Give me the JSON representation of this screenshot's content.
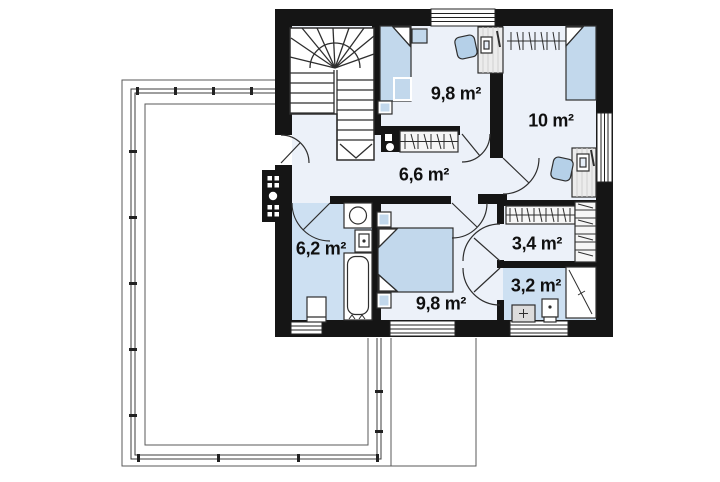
{
  "page": {
    "background_color": "#ffffff"
  },
  "floorplan": {
    "kind": "floor-plan-second-storey",
    "colors": {
      "wall": "#151515",
      "floor": "#ecf1f9",
      "wet_room_floor": "#cde0f2",
      "furniture_accent": "#c2d8ec",
      "outline": "#2e2e2e",
      "terrace_line": "#5a5a5a"
    },
    "rooms": [
      {
        "id": "bedroom-top",
        "type": "bedroom",
        "area_label": "9,8 m²"
      },
      {
        "id": "bedroom-right",
        "type": "bedroom",
        "area_label": "10 m²"
      },
      {
        "id": "hall",
        "type": "hall",
        "area_label": "6,6 m²"
      },
      {
        "id": "bathroom",
        "type": "bathroom",
        "area_label": "6,2 m²"
      },
      {
        "id": "wardrobe",
        "type": "wardrobe",
        "area_label": "3,4 m²"
      },
      {
        "id": "wc",
        "type": "toilet",
        "area_label": "3,2 m²"
      },
      {
        "id": "bedroom-bottom",
        "type": "bedroom",
        "area_label": "9,8 m²"
      }
    ]
  }
}
